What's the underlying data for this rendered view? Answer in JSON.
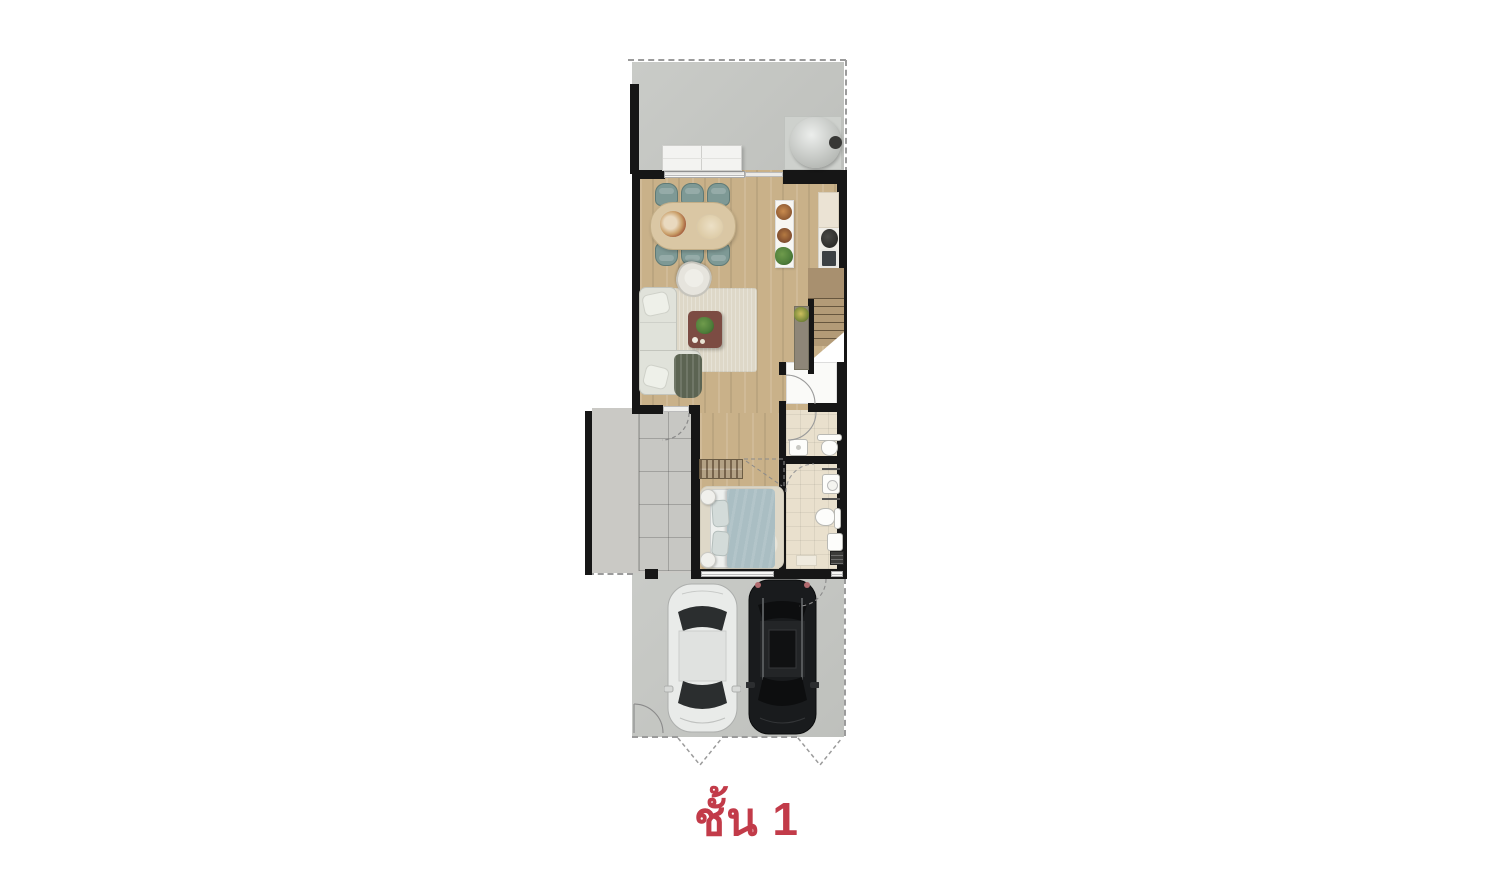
{
  "title": {
    "text": "ชั้น 1"
  },
  "colors": {
    "accent_red": "#c23b49",
    "wall": "#161616",
    "wood_floor": "#c9b189",
    "stair_wood": "#a8906f",
    "concrete": "#c6c8c4",
    "yard_concrete": "#cac9c5",
    "tile": "#e9e0cd",
    "rug": "#ded8c8",
    "sofa": "#e0e2da",
    "chair_teal": "#7e9995",
    "table_wood": "#dac7a4",
    "coffee_table": "#7c4c43",
    "bed_duvet": "#aabec3",
    "throw_green": "#5c6452",
    "car_white": "#e9ebe9",
    "car_black": "#191b1d",
    "plant_green": "#4e7d3a"
  },
  "furniture": [
    "terrace",
    "water-tank",
    "outdoor-bench",
    "dining-table",
    "dining-chair",
    "kitchen-counter",
    "cooktop",
    "kitchen-sink",
    "island-counter",
    "armchair",
    "sofa",
    "coffee-table",
    "living-rug",
    "staircase",
    "console-table",
    "under-stair-storage",
    "powder-room-washbasin",
    "powder-room-toilet",
    "bathroom-vanity",
    "bathroom-toilet",
    "shower-drain",
    "bath-mat",
    "bedroom-wardrobe",
    "double-bed",
    "bedside-table",
    "service-yard",
    "garage",
    "white-sedan-car",
    "black-suv-car",
    "driveway-entry-arrow"
  ]
}
